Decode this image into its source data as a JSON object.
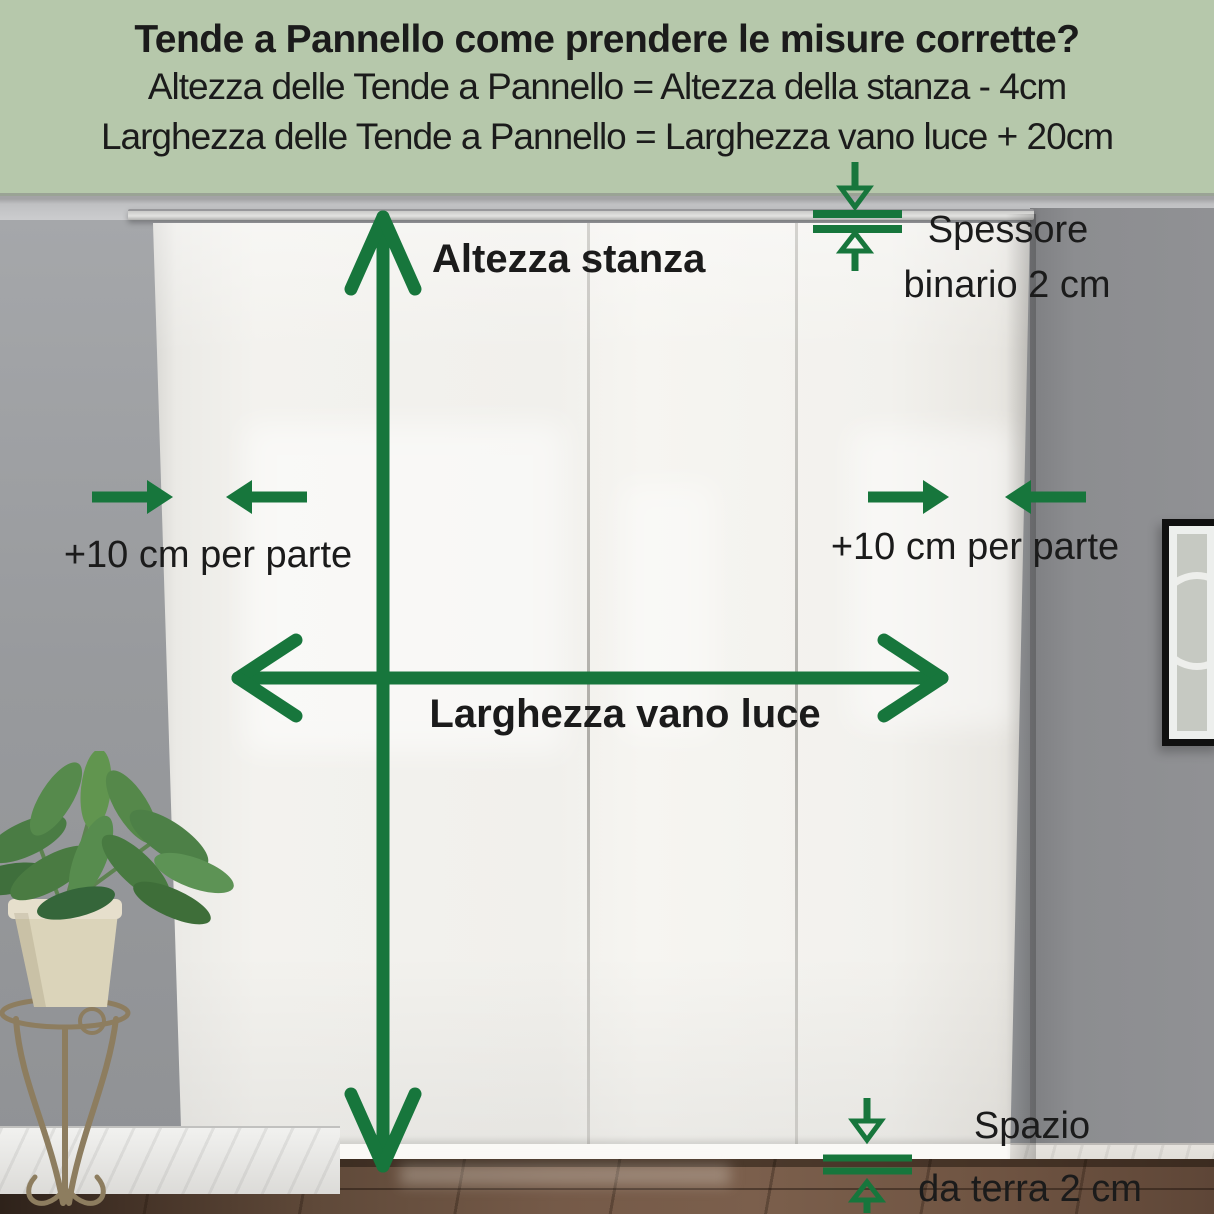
{
  "header": {
    "title": "Tende a Pannello come prendere le misure corrette?",
    "formulas": [
      "Altezza delle Tende a Pannello = Altezza della stanza - 4cm",
      "Larghezza delle Tende a Pannello = Larghezza vano luce + 20cm"
    ]
  },
  "labels": {
    "room_height": "Altezza stanza",
    "opening_width": "Larghezza vano luce",
    "side_left": "+10 cm per parte",
    "side_right": "+10 cm per parte",
    "track": {
      "line1": "Spessore",
      "line2": "binario 2 cm"
    },
    "floor_gap": {
      "line1": "Spazio",
      "line2": "da terra 2 cm"
    }
  },
  "colors": {
    "accent": "#17763c",
    "ink": "#1b1b1b",
    "header-bg": "#b6c8ab",
    "wall": "#9b9da0",
    "wall-right": "#8c8d90",
    "ceiling": "#c6c7c9",
    "curtain": "#f2f1ed",
    "pot": "#dbd4ba",
    "leaf": "#4a7c44"
  }
}
